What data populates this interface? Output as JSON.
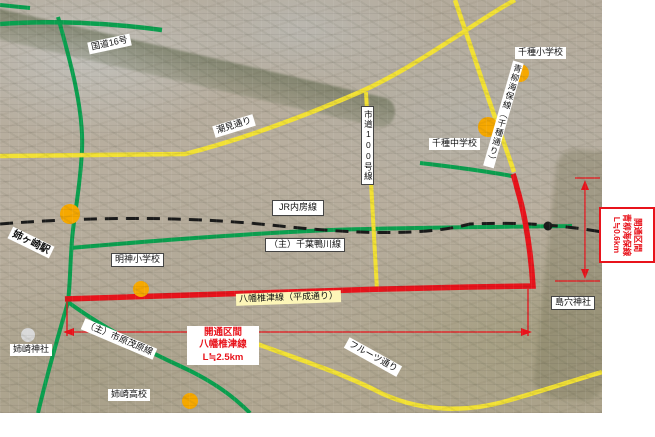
{
  "map": {
    "roads": {
      "route16": "国道16号",
      "shiomi_dori": "潮見通り",
      "jr_uchibo_line": "JR内房線",
      "shido_100": "市道100号線",
      "chiba_kamogawa": "（主）千葉鴨川線",
      "ichihara_mobara": "（主）市原茂原線",
      "yawata_shiizu_heisei": "八幡椎津線（平成通り）",
      "aoyagi_kaiho_chigusa": "青柳海保線（千種通り）",
      "fruits_dori": "フルーツ通り"
    },
    "places": {
      "anegasaki_station": "姉ヶ崎駅",
      "myojin_elementary": "明神小学校",
      "chigusa_elementary": "千種小学校",
      "chigusa_junior_high": "千種中学校",
      "anesaki_shrine": "姉崎神社",
      "anesaki_high_school": "姉崎高校",
      "shimaana_shrine": "島穴神社"
    },
    "annotations": {
      "opened_section_main": {
        "line1": "開通区間",
        "line2": "八幡椎津線",
        "line3": "L≒2.5km"
      },
      "opened_section_sub": {
        "line1": "開通区間",
        "line2": "青柳海保線",
        "line3": "L≒0.6km"
      }
    },
    "legend_colors": {
      "national_route_green": "#0aa04f",
      "city_road_yellow": "#f2e135",
      "opened_road_red": "#e8131b",
      "railway_black": "#1a1a1a",
      "poi_orange": "#f6a800",
      "shrine_dot_gray": "#d9d9d9"
    }
  }
}
